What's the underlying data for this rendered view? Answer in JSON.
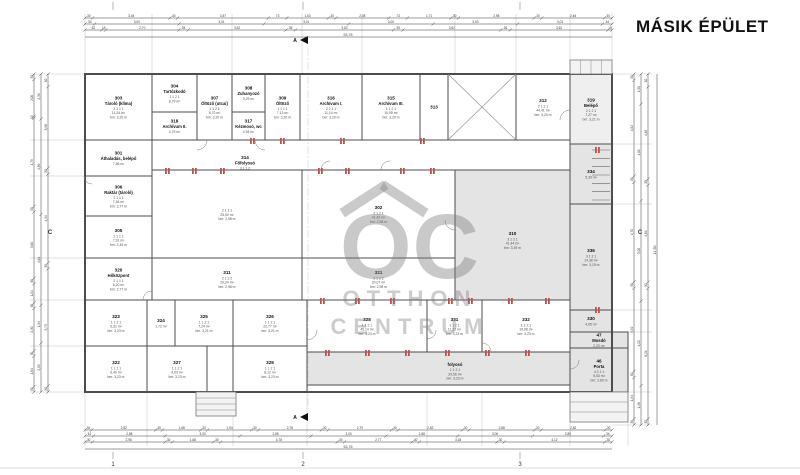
{
  "title": "MÁSIK ÉPÜLET",
  "watermark": {
    "monogram": "OC",
    "line1": "OTTHON",
    "line2": "CENTRUM"
  },
  "colors": {
    "wall": "#4d4d4d",
    "dim": "#3c3c3c",
    "gray_room": "#e4e4e4",
    "light_room": "#efefef",
    "red_accent": "#c0504d",
    "watermark_gray": "#9a9a9a",
    "ext_line": "#b8b8b8"
  },
  "plan": {
    "outline": {
      "x": 85,
      "y": 74,
      "w": 527,
      "h": 318
    },
    "rooms": [
      {
        "num": "303",
        "name": "Tároló (klíma)",
        "meta": [
          "2 1 1 1",
          "11,24 m²",
          "bm: 3,20 m"
        ],
        "x": 85,
        "y": 74,
        "w": 67,
        "h": 66
      },
      {
        "num": "304",
        "name": "Tartózkodó",
        "meta": [
          "1 1 2 1",
          "8,79 m²"
        ],
        "x": 152,
        "y": 74,
        "w": 45,
        "h": 38
      },
      {
        "num": "318",
        "name": "Archívum II.",
        "meta": [
          "4,79 m²"
        ],
        "x": 152,
        "y": 112,
        "w": 45,
        "h": 28
      },
      {
        "num": "307",
        "name": "Öltöző (utcai)",
        "meta": [
          "1 1 2 1",
          "8,70 m²",
          "bm: 3,20 m"
        ],
        "x": 197,
        "y": 74,
        "w": 35,
        "h": 66
      },
      {
        "num": "308",
        "name": "Zuhanyozó",
        "meta": [
          "3,29 m²"
        ],
        "x": 232,
        "y": 74,
        "w": 33,
        "h": 38
      },
      {
        "num": "317",
        "name": "Kézmosó, wc",
        "meta": [
          "4,94 m²"
        ],
        "x": 232,
        "y": 112,
        "w": 33,
        "h": 28
      },
      {
        "num": "309",
        "name": "Öltöző",
        "meta": [
          "1 1 1 1",
          "7,13 m²",
          "bm: 3,20 m"
        ],
        "x": 265,
        "y": 74,
        "w": 35,
        "h": 66
      },
      {
        "num": "316",
        "name": "Archívum I.",
        "meta": [
          "2 2 1 1",
          "11,14 m²",
          "bm: 3,20 m"
        ],
        "x": 300,
        "y": 74,
        "w": 62,
        "h": 66
      },
      {
        "num": "315",
        "name": "Archívum III.",
        "meta": [
          "1 1 2 1",
          "10,95 m²",
          "bm: 3,20 m"
        ],
        "x": 362,
        "y": 74,
        "w": 58,
        "h": 66
      },
      {
        "num": "313",
        "name": "",
        "meta": [],
        "x": 420,
        "y": 74,
        "w": 28,
        "h": 66
      },
      {
        "num": "",
        "name": "",
        "meta": [],
        "x": 448,
        "y": 74,
        "w": 68,
        "h": 66
      },
      {
        "num": "312",
        "name": "",
        "meta": [
          "2 1 2 1",
          "44,41 m²",
          "bm: 3,20 m"
        ],
        "x": 516,
        "y": 74,
        "w": 54,
        "h": 66
      },
      {
        "num": "319",
        "name": "Belépő",
        "meta": [
          "2 1 2 1",
          "7,27 m²",
          "bm: 3,21 m"
        ],
        "x": 570,
        "y": 74,
        "w": 42,
        "h": 70,
        "fill": "light"
      },
      {
        "num": "301",
        "name": "Áthaladás, belépő",
        "meta": [
          "7,86 m²"
        ],
        "x": 85,
        "y": 140,
        "w": 67,
        "h": 36
      },
      {
        "num": "314",
        "name": "Főfolyosó",
        "meta": [
          "3 1 1 2",
          "57,33 m²",
          "bm: 3,20 m"
        ],
        "x": 152,
        "y": 140,
        "w": 418,
        "h": 30,
        "lx": 245,
        "ly": 155
      },
      {
        "num": "306",
        "name": "Raktár (tároló)",
        "meta": [
          "2 1 1 1",
          "7,46 m²",
          "bm: 2,77 m"
        ],
        "x": 85,
        "y": 176,
        "w": 67,
        "h": 40
      },
      {
        "num": "305",
        "name": "",
        "meta": [
          "2 1 1 1",
          "7,91 m²",
          "bm: 2,45 m"
        ],
        "x": 85,
        "y": 216,
        "w": 67,
        "h": 42
      },
      {
        "num": "320",
        "name": "Hőközpont",
        "meta": [
          "2 1 1 1",
          "6,20 m²",
          "bm: 2,77 m"
        ],
        "x": 85,
        "y": 258,
        "w": 67,
        "h": 42
      },
      {
        "num": "",
        "name": "",
        "meta": [
          "2 1 1 1",
          "25,60 m²",
          "bm: 2,98 m"
        ],
        "x": 152,
        "y": 170,
        "w": 150,
        "h": 88
      },
      {
        "num": "302",
        "name": "",
        "meta": [
          "2 1 2 1",
          "41,42 m²",
          "bm: 2,98 m"
        ],
        "x": 302,
        "y": 170,
        "w": 153,
        "h": 88
      },
      {
        "num": "311",
        "name": "",
        "meta": [
          "2 1 2 2",
          "20,24 m²",
          "bm: 2,98 m"
        ],
        "x": 152,
        "y": 258,
        "w": 150,
        "h": 42
      },
      {
        "num": "321",
        "name": "",
        "meta": [
          "2 1 2 2",
          "20,07 m²",
          "bm: 2,98 m"
        ],
        "x": 302,
        "y": 258,
        "w": 153,
        "h": 42
      },
      {
        "num": "310",
        "name": "",
        "meta": [
          "3 1 2 1",
          "41,44 m²",
          "bm: 3,39 m"
        ],
        "x": 455,
        "y": 170,
        "w": 115,
        "h": 140,
        "fill": "gray"
      },
      {
        "num": "334",
        "name": "",
        "meta": [
          "5,39 m²"
        ],
        "x": 570,
        "y": 144,
        "w": 42,
        "h": 60,
        "fill": "gray"
      },
      {
        "num": "336",
        "name": "",
        "meta": [
          "3 1 2 1",
          "14,38 m²",
          "bm: 3,19 m"
        ],
        "x": 570,
        "y": 204,
        "w": 42,
        "h": 106,
        "fill": "gray"
      },
      {
        "num": "323",
        "name": "",
        "meta": [
          "1 1 2 1",
          "6,31 m²",
          "bm: 3,23 m"
        ],
        "x": 85,
        "y": 300,
        "w": 62,
        "h": 46
      },
      {
        "num": "322",
        "name": "",
        "meta": [
          "1 1 1 1",
          "6,40 m²",
          "bm: 3,23 m"
        ],
        "x": 85,
        "y": 346,
        "w": 62,
        "h": 46
      },
      {
        "num": "324",
        "name": "",
        "meta": [
          "1,72 m²"
        ],
        "x": 147,
        "y": 300,
        "w": 28,
        "h": 46
      },
      {
        "num": "325",
        "name": "",
        "meta": [
          "1 1 2 1",
          "7,24 m²",
          "bm: 3,21 m"
        ],
        "x": 175,
        "y": 300,
        "w": 58,
        "h": 46
      },
      {
        "num": "326",
        "name": "",
        "meta": [
          "1 1 2 1",
          "22,77 m²",
          "bm: 3,21 m"
        ],
        "x": 233,
        "y": 300,
        "w": 74,
        "h": 46
      },
      {
        "num": "327",
        "name": "",
        "meta": [
          "1 1 2 1",
          "4,03 m²",
          "bm: 3,23 m"
        ],
        "x": 147,
        "y": 346,
        "w": 60,
        "h": 46
      },
      {
        "num": "329",
        "name": "",
        "meta": [
          "1 1 2 1",
          "8,12 m²",
          "bm: 3,23 m"
        ],
        "x": 233,
        "y": 346,
        "w": 74,
        "h": 46
      },
      {
        "num": "328",
        "name": "",
        "meta": [
          "1 1 2 1",
          "45,14 m²",
          "bm: 3,23 m"
        ],
        "x": 307,
        "y": 300,
        "w": 120,
        "h": 52
      },
      {
        "num": "331",
        "name": "",
        "meta": [
          "1 1 2 1",
          "11,27 m²",
          "bm: 3,23 m"
        ],
        "x": 427,
        "y": 300,
        "w": 55,
        "h": 52
      },
      {
        "num": "332",
        "name": "",
        "meta": [
          "1 1 2 1",
          "19,98 m²",
          "bm: 3,23 m"
        ],
        "x": 482,
        "y": 300,
        "w": 88,
        "h": 52
      },
      {
        "num": "330",
        "name": "",
        "meta": [
          "4,05 m²"
        ],
        "x": 570,
        "y": 310,
        "w": 42,
        "h": 22,
        "fill": "gray"
      },
      {
        "num": "",
        "name": "folyosó",
        "meta": [
          "1 1 2 1",
          "29,56 m²",
          "bm: 3,23 m"
        ],
        "x": 307,
        "y": 352,
        "w": 263,
        "h": 33,
        "fill": "gray",
        "lx": 455,
        "ly": 362
      },
      {
        "num": "47",
        "name": "Mosdó",
        "meta": [
          "2,20 m²"
        ],
        "x": 570,
        "y": 332,
        "w": 58,
        "h": 16,
        "fill": "gray"
      },
      {
        "num": "46",
        "name": "Porta",
        "meta": [
          "4 2 1 1",
          "5,53 m²",
          "bm: 2,80 m"
        ],
        "x": 570,
        "y": 348,
        "w": 58,
        "h": 44,
        "fill": "gray"
      }
    ],
    "cross_decor": {
      "x": 448,
      "y": 74,
      "w": 68,
      "h": 66
    },
    "stair": {
      "x": 592,
      "y": 150,
      "w": 18,
      "h": 50,
      "steps": 6
    },
    "steps": [
      {
        "x": 570,
        "y": 60,
        "w": 42,
        "h": 14,
        "dir": "v",
        "n": 4
      },
      {
        "x": 196,
        "y": 392,
        "w": 40,
        "h": 24,
        "dir": "h",
        "n": 4
      },
      {
        "x": 570,
        "y": 392,
        "w": 58,
        "h": 30,
        "dir": "h",
        "n": 3
      }
    ],
    "doors": [
      {
        "cx": 197,
        "cy": 140,
        "r": 10,
        "dir": 0
      },
      {
        "cx": 265,
        "cy": 140,
        "r": 10,
        "dir": 1
      },
      {
        "cx": 330,
        "cy": 170,
        "r": 9,
        "dir": 2
      },
      {
        "cx": 390,
        "cy": 170,
        "r": 9,
        "dir": 2
      },
      {
        "cx": 455,
        "cy": 220,
        "r": 10,
        "dir": 1
      },
      {
        "cx": 307,
        "cy": 330,
        "r": 10,
        "dir": 0
      },
      {
        "cx": 427,
        "cy": 330,
        "r": 9,
        "dir": 0
      },
      {
        "cx": 482,
        "cy": 352,
        "r": 9,
        "dir": 3
      },
      {
        "cx": 570,
        "cy": 360,
        "r": 9,
        "dir": 0
      },
      {
        "cx": 152,
        "cy": 300,
        "r": 9,
        "dir": 2
      },
      {
        "cx": 92,
        "cy": 176,
        "r": 8,
        "dir": 1
      },
      {
        "cx": 570,
        "cy": 120,
        "r": 10,
        "dir": 2
      }
    ],
    "red_marks": [
      [
        165,
        171
      ],
      [
        192,
        171
      ],
      [
        220,
        171
      ],
      [
        318,
        171
      ],
      [
        345,
        171
      ],
      [
        400,
        171
      ],
      [
        430,
        171
      ],
      [
        320,
        301
      ],
      [
        355,
        301
      ],
      [
        390,
        301
      ],
      [
        448,
        301
      ],
      [
        468,
        301
      ],
      [
        508,
        301
      ],
      [
        545,
        301
      ],
      [
        325,
        353
      ],
      [
        365,
        353
      ],
      [
        405,
        353
      ],
      [
        445,
        353
      ],
      [
        485,
        353
      ],
      [
        525,
        353
      ],
      [
        250,
        141
      ],
      [
        280,
        141
      ],
      [
        340,
        141
      ],
      [
        420,
        141
      ],
      [
        595,
        150
      ],
      [
        595,
        310
      ]
    ],
    "section": {
      "x": 308,
      "y0": 40,
      "y1": 417,
      "label": "A"
    }
  },
  "dims": {
    "top_rows": [
      {
        "y": 18,
        "vals": [
          "30",
          "3,04",
          "30",
          "3,57",
          "73",
          "1,63",
          "30",
          "2,08",
          "73",
          "1,71",
          "30",
          "2,98",
          "30",
          "2,46",
          "30"
        ]
      },
      {
        "y": 24,
        "vals": [
          "34",
          "3,00",
          "3,01",
          "3,01",
          "3,00",
          "3,00",
          "3,01",
          "34"
        ]
      },
      {
        "y": 30,
        "vals": [
          "62",
          "15",
          "2,70",
          "35",
          "3,62",
          "35",
          "3,63",
          "35",
          "3,62",
          "35",
          "3,62",
          "15"
        ]
      }
    ],
    "top_total": {
      "y": 37,
      "label": "53,76"
    },
    "bottom_rows": [
      {
        "y": 430,
        "vals": [
          "30",
          "2,82",
          "30",
          "1,68",
          "30",
          "1,94",
          "30",
          "2,78",
          "30",
          "2,79",
          "30",
          "2,82",
          "30",
          "2,88",
          "30",
          "2,82",
          "30"
        ]
      },
      {
        "y": 436,
        "vals": [
          "34",
          "2,88",
          "3,00",
          "2,85",
          "3,00",
          "2,88",
          "3,00",
          "2,85",
          "34"
        ]
      },
      {
        "y": 442,
        "vals": [
          "30",
          "2,98",
          "30",
          "1,68",
          "30",
          "4,78",
          "30",
          "2,77",
          "30",
          "3,18",
          "30",
          "4,12",
          "30"
        ]
      }
    ],
    "bottom_total": {
      "y": 449,
      "label": "53,76"
    },
    "left_rows": [
      {
        "x": 34,
        "vals": [
          "30",
          "2,00",
          "10",
          "4,79",
          "30",
          "3,60",
          "30",
          "1,04",
          "30",
          "2,30",
          "30",
          "1,64",
          "30"
        ]
      },
      {
        "x": 41,
        "vals": [
          "2,30",
          "4,89",
          "4,64",
          "1,94",
          "2,50"
        ]
      },
      {
        "x": 48,
        "vals": [
          "62",
          "3,98",
          "30",
          "4,34",
          "30",
          "5,73",
          "30"
        ]
      }
    ],
    "right_rows": [
      {
        "x": 634,
        "vals": [
          "30",
          "4,52",
          "30",
          "4,70",
          "30",
          "3,92",
          "30",
          "1,94",
          "30"
        ]
      },
      {
        "x": 641,
        "vals": [
          "1,50",
          "4,82",
          "5,00",
          "4,22",
          "1,96"
        ]
      },
      {
        "x": 648,
        "vals": [
          "62",
          "4,40",
          "30",
          "4,64",
          "30",
          "6,24",
          "30"
        ]
      }
    ],
    "right_total": {
      "x": 657,
      "label": "14,50"
    }
  },
  "grid": {
    "bottom_numbers": [
      {
        "label": "1",
        "x": 113
      },
      {
        "label": "2",
        "x": 303
      },
      {
        "label": "3",
        "x": 520
      }
    ],
    "top_ticks": [
      113,
      303,
      520
    ],
    "side_letters": [
      {
        "label": "C",
        "x": 50,
        "y": 234
      },
      {
        "label": "C",
        "x": 640,
        "y": 234
      }
    ]
  },
  "ext_lines": {
    "top_xs": [
      85,
      152,
      232,
      302,
      362,
      455,
      516,
      570,
      612
    ],
    "bottom_xs": [
      85,
      147,
      233,
      307,
      427,
      482,
      570,
      628
    ],
    "left_ys": [
      74,
      140,
      176,
      258,
      300,
      346,
      392
    ],
    "right_ys": [
      74,
      144,
      204,
      310,
      332,
      392,
      425
    ]
  }
}
